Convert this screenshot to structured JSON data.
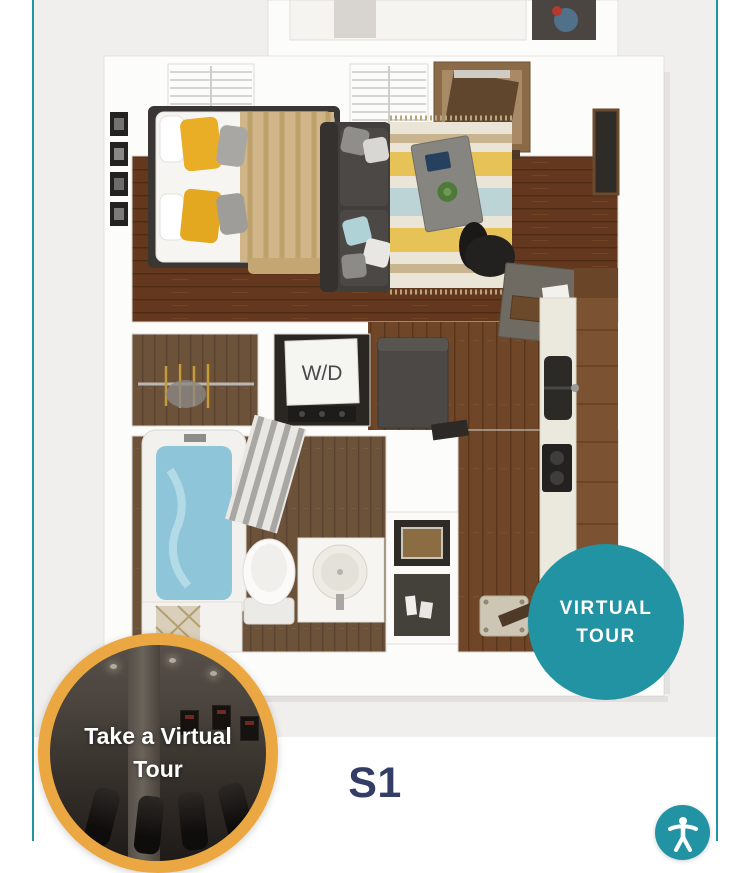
{
  "card": {
    "title": "S1",
    "accent_color": "#2193a3"
  },
  "floorplan": {
    "washer_dryer_label": "W/D",
    "background_color": "#f0efed"
  },
  "virtual_tour_badge": {
    "line1": "VIRTUAL",
    "line2": "TOUR",
    "background_color": "#2193a3",
    "text_color": "#ffffff"
  },
  "virtual_tour_thumbnail": {
    "label": "Take a Virtual Tour",
    "ring_color": "#eba742"
  },
  "accessibility_button": {
    "icon": "accessibility-person-icon",
    "background_color": "#2193a3"
  }
}
